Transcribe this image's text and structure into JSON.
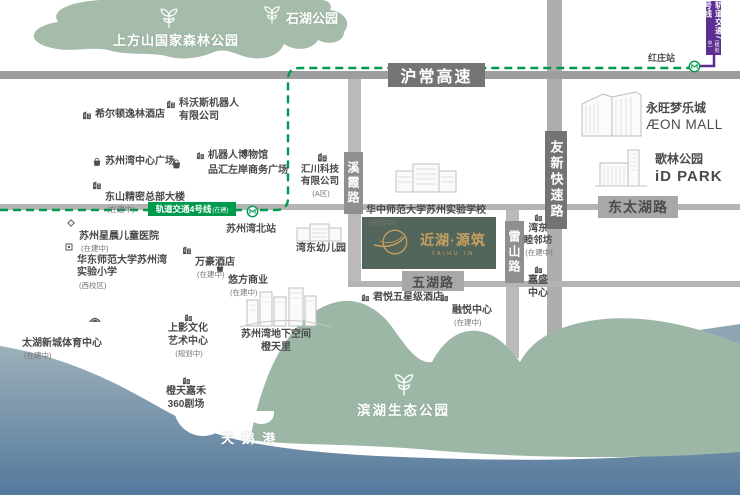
{
  "colors": {
    "park_green_top": "#a5bcab",
    "park_green_bottom": "#9db7a7",
    "water_top": "#9db0ba",
    "water_bottom": "#54799c",
    "rail_line4_green": "#009a4e",
    "rail_line7_purple": "#5b2e90",
    "road_gray": "#9d9d9d",
    "brand_green": "#53665b",
    "brand_gold": "#c8a15f"
  },
  "rail": {
    "line4": "轨道交通4号线",
    "line4_note": "(在建)",
    "line7": "轨道交通7号线",
    "line7_note": "(规划中)",
    "station_north": "苏州湾北站",
    "station_hongzhuang": "红庄站"
  },
  "roads": {
    "huchang": "沪常高速",
    "youxin": "友新快速路",
    "dongtaihu": "东太湖路",
    "wuhu": "五湖路",
    "xixia": "溪霞路",
    "leishan": "雷山路"
  },
  "parks": {
    "shangfangshan": "上方山国家森林公园",
    "shihu": "石湖公园",
    "binhu": "滨湖生态公园",
    "tiane": "天 鹅 港"
  },
  "project": {
    "name": "近湖·源筑",
    "latin": "TAIHU IN"
  },
  "landmarks": {
    "kewosi": {
      "name": "科沃斯机器人\n有限公司"
    },
    "hilton": {
      "name": "希尔顿逸林酒店"
    },
    "center_plaza": {
      "name": "苏州湾中心广场"
    },
    "robot_museum": {
      "name": "机器人博物馆"
    },
    "pinhui": {
      "name": "品汇左岸商务广场"
    },
    "dongshan": {
      "name": "东山精密总部大楼",
      "note": "(在建中)"
    },
    "huichuan": {
      "name": "汇川科技\n有限公司",
      "note": "(A区)"
    },
    "school": {
      "name": "华中师范大学苏州实验学校",
      "note": "(规划中)"
    },
    "hospital": {
      "name": "苏州星晨儿童医院",
      "note": "(在建中)"
    },
    "ecnu": {
      "name": "华东师范大学苏州湾\n实验小学",
      "note": "(西校区)"
    },
    "marriott": {
      "name": "万豪酒店",
      "note": "(在建中)"
    },
    "ufang": {
      "name": "悠方商业",
      "note": "(在建中)"
    },
    "kindergarten": {
      "name": "湾东幼儿园"
    },
    "aeon": {
      "name": "永旺梦乐城",
      "sub": "ÆON MALL"
    },
    "idpark": {
      "name": "歌林公园",
      "sub": "iD PARK"
    },
    "mulinfang": {
      "name": "湾东\n睦邻坊",
      "note": "(在建中)"
    },
    "jiasheng": {
      "name": "嘉盛\n中心"
    },
    "junyue": {
      "name": "君悦五星级酒店"
    },
    "rongyue": {
      "name": "融悦中心",
      "note": "(在建中)"
    },
    "sports": {
      "name": "太湖新城体育中心",
      "note": "(在建中)"
    },
    "shangying": {
      "name": "上影文化\n艺术中心",
      "note": "(规划中)"
    },
    "theater360": {
      "name": "橙天嘉禾\n360剧场"
    },
    "underground": {
      "name": "苏州湾地下空间\n橙天里"
    }
  }
}
